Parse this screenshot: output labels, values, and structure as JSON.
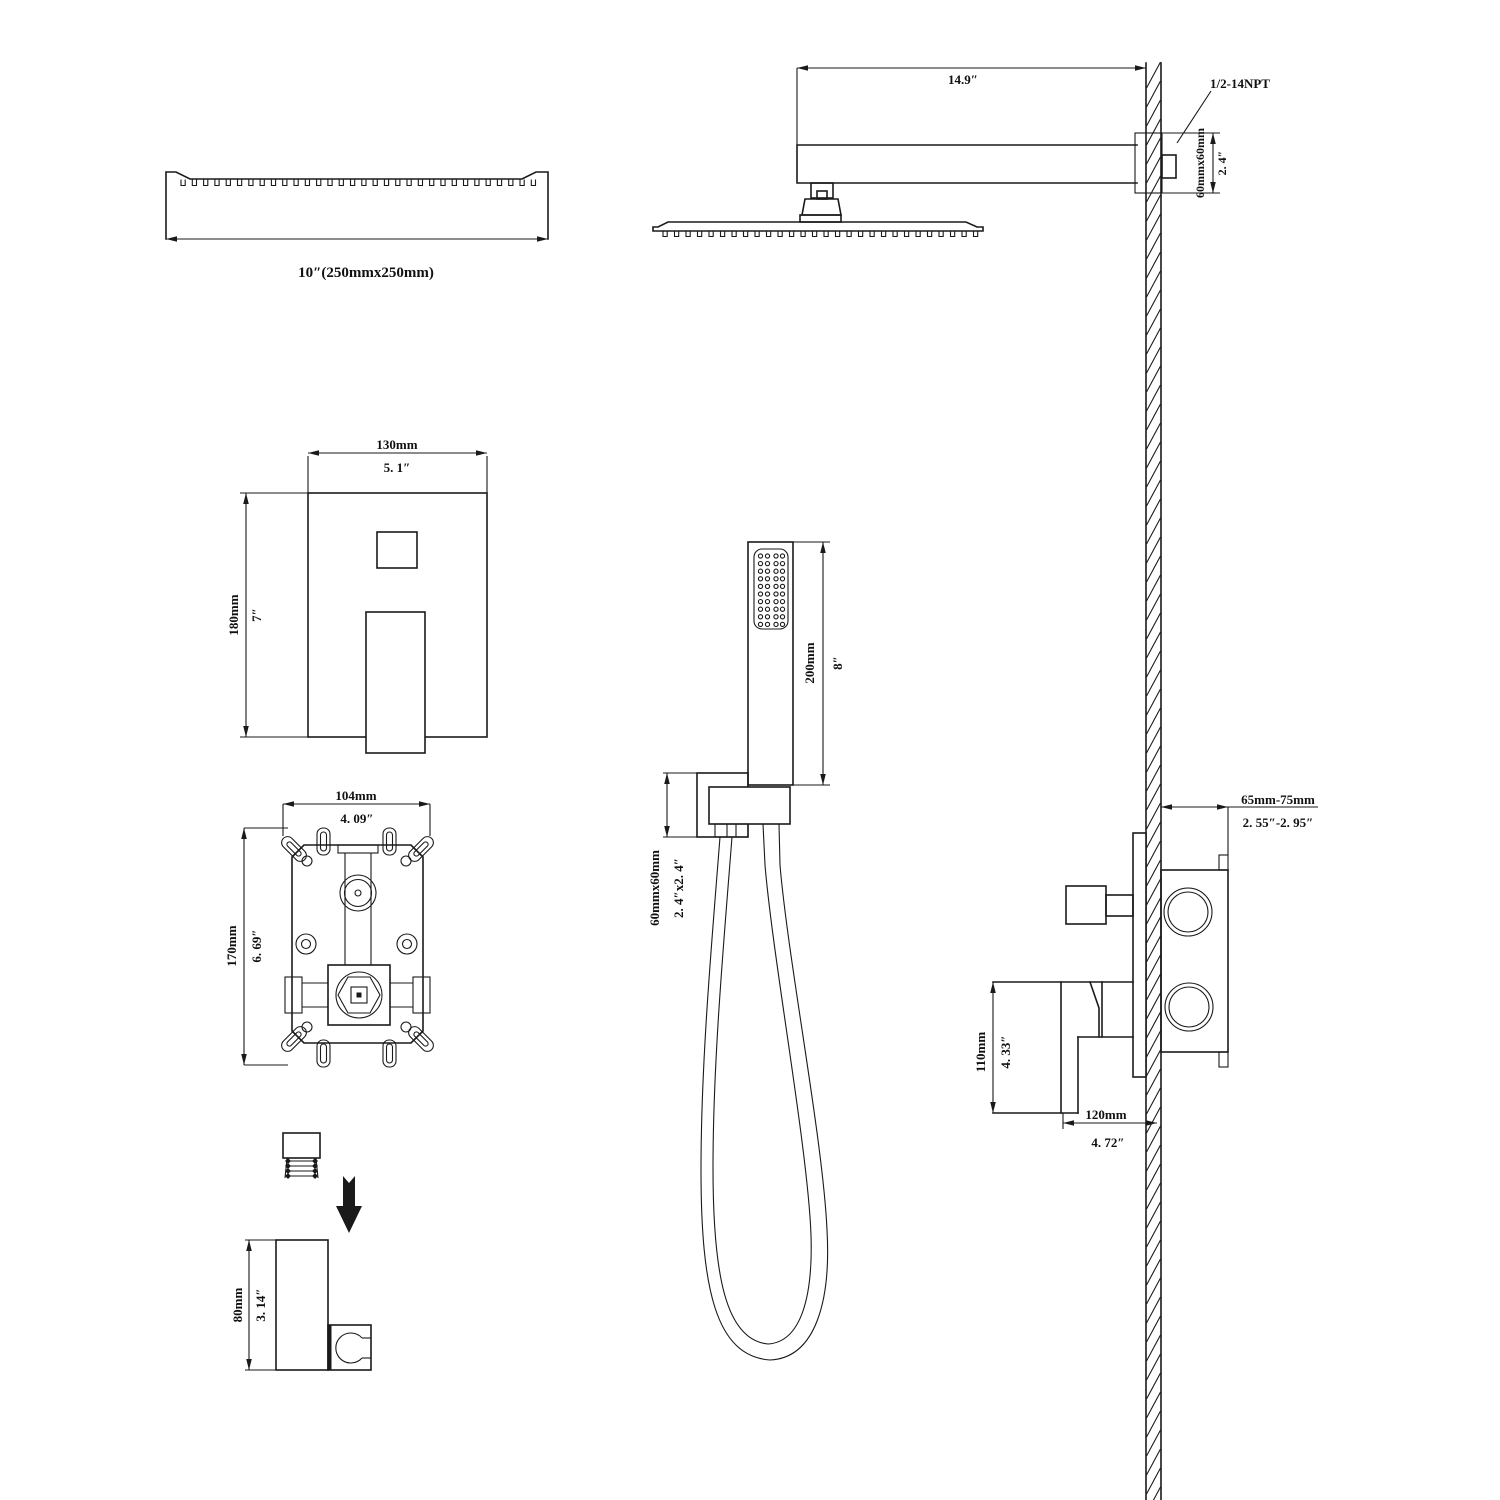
{
  "drawing": {
    "head_top_view": {
      "label": "10″(250mmx250mm)"
    },
    "head_side_view": {
      "arm_length_in": "14.9″",
      "thread": "1/2-14NPT",
      "flange_size_mm": "60mmx60mm",
      "flange_size_in": "2. 4″"
    },
    "trim_plate": {
      "width_mm": "130mm",
      "width_in": "5. 1″",
      "height_mm": "180mm",
      "height_in": "7″"
    },
    "rough_in_valve": {
      "width_mm": "104mm",
      "width_in": "4. 09″",
      "height_mm": "170mm",
      "height_in": "6. 69″"
    },
    "hand_shower": {
      "length_mm": "200mm",
      "length_in": "8″",
      "bracket_mm": "60mmx60mm",
      "bracket_in": "2. 4″x2. 4″"
    },
    "valve_side_view": {
      "depth_mm": "65mm-75mm",
      "depth_in": "2. 55″-2. 95″",
      "height_mm": "110mm",
      "height_in": "4. 33″",
      "width_mm": "120mm",
      "width_in": "4. 72″"
    },
    "bracket_detail": {
      "height_mm": "80mm",
      "height_in": "3. 14″"
    }
  },
  "colors": {
    "line": "#1a1a1a",
    "background": "#ffffff"
  }
}
